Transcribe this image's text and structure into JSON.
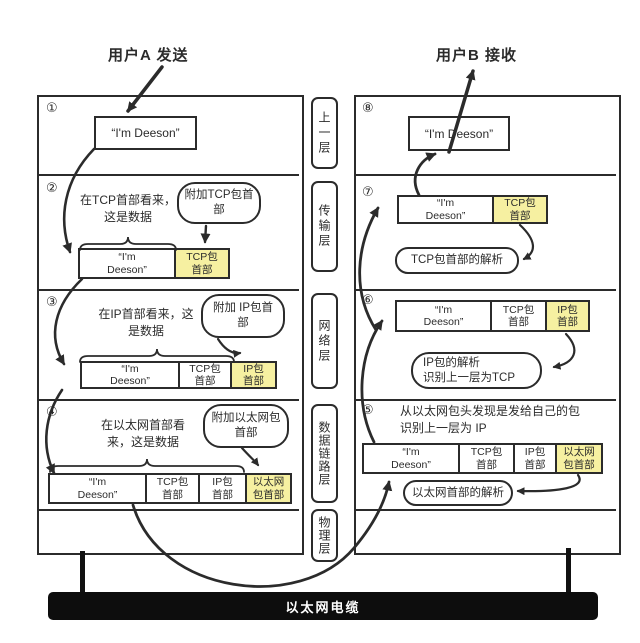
{
  "header": {
    "sender_label": "用户A 发送",
    "receiver_label": "用户B 接收"
  },
  "message": "“I'm Deeson”",
  "layers": [
    "上一层",
    "传输层",
    "网络层",
    "数据链路层",
    "物理层"
  ],
  "cable_label": "以太网电缆",
  "colors": {
    "ink": "#2b2b2b",
    "highlight": "#f6f0a1",
    "cable": "#0d0d0d",
    "background": "#ffffff"
  },
  "left_rows": [
    {
      "num": "①",
      "segments": [
        "“I'm Deeson”"
      ]
    },
    {
      "num": "②",
      "note": "在TCP首部看来，\n这是数据",
      "bubble": "附加TCP包首\n部",
      "segments": [
        "“I'm\nDeeson”",
        "TCP包\n首部"
      ]
    },
    {
      "num": "③",
      "note": "在IP首部看来，这\n是数据",
      "bubble": "附加 IP包首\n部",
      "segments": [
        "“I'm\nDeeson”",
        "TCP包\n首部",
        "IP包\n首部"
      ]
    },
    {
      "num": "④",
      "note": "在以太网首部看\n来，这是数据",
      "bubble": "附加以太网包\n首部",
      "segments": [
        "“I'm\nDeeson”",
        "TCP包\n首部",
        "IP包\n首部",
        "以太网\n包首部"
      ]
    }
  ],
  "right_rows": [
    {
      "num": "⑧",
      "segments": [
        "“I'm Deeson”"
      ]
    },
    {
      "num": "⑦",
      "bubble": "TCP包首部的解析",
      "segments": [
        "“I'm\nDeeson”",
        "TCP包\n首部"
      ]
    },
    {
      "num": "⑥",
      "bubble": "IP包的解析\n识别上一层为TCP",
      "segments": [
        "“I'm\nDeeson”",
        "TCP包\n首部",
        "IP包\n首部"
      ]
    },
    {
      "num": "⑤",
      "note": "从以太网包头发现是发给自己的包\n识别上一层为 IP",
      "bubble": "以太网首部的解析",
      "segments": [
        "“I'm\nDeeson”",
        "TCP包\n首部",
        "IP包\n首部",
        "以太网\n包首部"
      ]
    }
  ]
}
